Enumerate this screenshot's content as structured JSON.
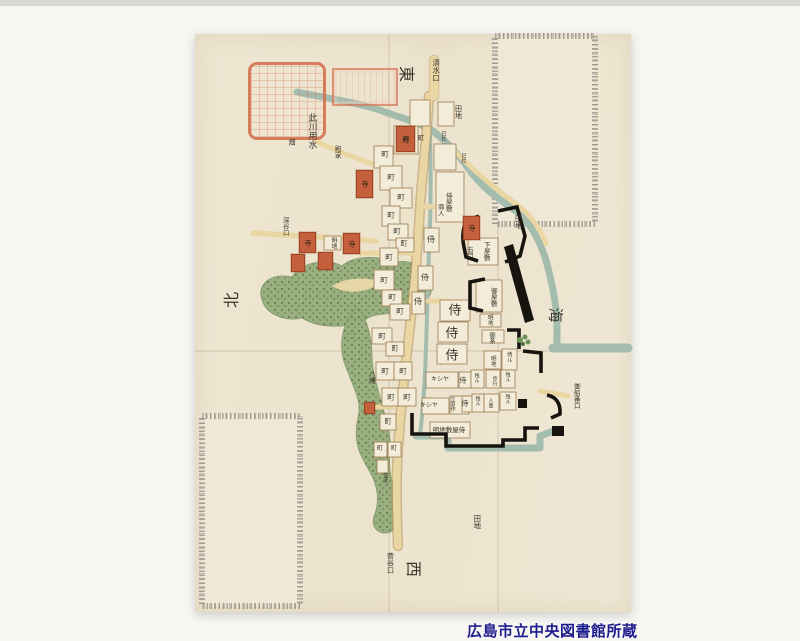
{
  "caption": {
    "text": "広島市立中央図書館所蔵"
  },
  "map": {
    "colors": {
      "background": "#f7f6f3",
      "background_top_strip": "#d8d6d3",
      "paper": "#ede4cf",
      "road": "#e9d6a2",
      "road_edge": "#b5905c",
      "block": "#f3ecd8",
      "block_edge": "#9b7b50",
      "water": "#a4bcae",
      "hill_green": "#96ad7c",
      "hill_dot": "#59753f",
      "temple_red": "#c4613c",
      "castle_wall": "#17140f",
      "seal_red": "#d4714e",
      "ink": "#3a342c",
      "caption_navy": "#1c1c8f",
      "speckle_gray": "#a29d94"
    },
    "labels": [
      {
        "t": "東",
        "x": 406,
        "y": 74,
        "s": 16,
        "r": 90
      },
      {
        "t": "北",
        "x": 232,
        "y": 300,
        "s": 16,
        "r": -90
      },
      {
        "t": "海",
        "x": 555,
        "y": 315,
        "s": 15,
        "r": 90
      },
      {
        "t": "西",
        "x": 413,
        "y": 569,
        "s": 16,
        "r": 90
      },
      {
        "t": "清水口",
        "x": 436,
        "y": 70,
        "s": 7.5,
        "m": "v"
      },
      {
        "t": "田地",
        "x": 458,
        "y": 112,
        "s": 7,
        "m": "v"
      },
      {
        "t": "此川用水",
        "x": 311,
        "y": 131,
        "s": 9,
        "m": "v"
      },
      {
        "t": "畑",
        "x": 292,
        "y": 143,
        "s": 7
      },
      {
        "t": "殿家",
        "x": 337,
        "y": 152,
        "s": 6.5,
        "m": "v"
      },
      {
        "t": "深谷口",
        "x": 285,
        "y": 226,
        "s": 6.5,
        "m": "v"
      },
      {
        "t": "明地",
        "x": 333,
        "y": 243,
        "s": 6,
        "m": "v"
      },
      {
        "t": "田地",
        "x": 518,
        "y": 222,
        "s": 7,
        "m": "v"
      },
      {
        "t": "八幡",
        "x": 371,
        "y": 377,
        "s": 6.5,
        "m": "v"
      },
      {
        "t": "御船番口",
        "x": 576,
        "y": 396,
        "s": 6.5,
        "m": "v"
      },
      {
        "t": "田地",
        "x": 477,
        "y": 522,
        "s": 7.5,
        "m": "v"
      },
      {
        "t": "菅谷口",
        "x": 390,
        "y": 563,
        "s": 7,
        "m": "v"
      },
      {
        "t": "並木",
        "x": 384,
        "y": 478,
        "s": 5.5,
        "m": "v"
      },
      {
        "t": "巳社",
        "x": 443,
        "y": 136,
        "s": 5,
        "m": "v"
      },
      {
        "t": "巳社",
        "x": 463,
        "y": 158,
        "s": 5,
        "m": "v"
      },
      {
        "t": "侍屋敷",
        "x": 448,
        "y": 202,
        "s": 6.5,
        "m": "v"
      },
      {
        "t": "商人",
        "x": 440,
        "y": 210,
        "s": 6.5,
        "m": "v"
      },
      {
        "t": "下屋敷",
        "x": 486,
        "y": 251,
        "s": 6.5,
        "m": "v"
      },
      {
        "t": "右門",
        "x": 469,
        "y": 252,
        "s": 6,
        "m": "v"
      },
      {
        "t": "御屋敷",
        "x": 493,
        "y": 297,
        "s": 6.5,
        "m": "v"
      },
      {
        "t": "明地",
        "x": 489,
        "y": 320,
        "s": 5.5,
        "m": "v"
      },
      {
        "t": "御茶",
        "x": 491,
        "y": 338,
        "s": 6,
        "m": "v"
      },
      {
        "t": "明地",
        "x": 492,
        "y": 361,
        "s": 5.5,
        "m": "v"
      },
      {
        "t": "侍ル",
        "x": 508,
        "y": 357,
        "s": 5.5,
        "m": "v"
      },
      {
        "t": "残ル",
        "x": 476,
        "y": 378,
        "s": 5,
        "m": "v"
      },
      {
        "t": "歩行",
        "x": 494,
        "y": 381,
        "s": 5,
        "m": "v"
      },
      {
        "t": "残ル",
        "x": 507,
        "y": 377,
        "s": 5,
        "m": "v"
      },
      {
        "t": "キシヤ",
        "x": 440,
        "y": 380,
        "s": 6
      },
      {
        "t": "侍",
        "x": 463,
        "y": 381,
        "s": 7
      },
      {
        "t": "キシヤ",
        "x": 429,
        "y": 406,
        "s": 6
      },
      {
        "t": "立退作",
        "x": 452,
        "y": 404,
        "s": 5,
        "m": "v"
      },
      {
        "t": "侍",
        "x": 465,
        "y": 404,
        "s": 7
      },
      {
        "t": "残ル",
        "x": 477,
        "y": 401,
        "s": 5,
        "m": "v"
      },
      {
        "t": "人置",
        "x": 490,
        "y": 403,
        "s": 5,
        "m": "v"
      },
      {
        "t": "残ル",
        "x": 507,
        "y": 399,
        "s": 5,
        "m": "v"
      },
      {
        "t": "明地敷屋侍",
        "x": 449,
        "y": 430,
        "s": 6.5
      },
      {
        "t": "侍",
        "x": 431,
        "y": 240,
        "s": 8
      },
      {
        "t": "侍",
        "x": 425,
        "y": 278,
        "s": 8
      },
      {
        "t": "侍",
        "x": 418,
        "y": 302,
        "s": 8
      },
      {
        "t": "侍",
        "x": 455,
        "y": 311,
        "s": 13
      },
      {
        "t": "侍",
        "x": 452,
        "y": 334,
        "s": 13
      },
      {
        "t": "侍",
        "x": 452,
        "y": 356,
        "s": 13
      },
      {
        "t": "町",
        "x": 406,
        "y": 140,
        "s": 7.5
      },
      {
        "t": "町",
        "x": 421,
        "y": 138,
        "s": 6.5
      },
      {
        "t": "町",
        "x": 385,
        "y": 154,
        "s": 7.5
      },
      {
        "t": "町",
        "x": 391,
        "y": 177,
        "s": 7.5
      },
      {
        "t": "町",
        "x": 401,
        "y": 197,
        "s": 7.5
      },
      {
        "t": "町",
        "x": 391,
        "y": 215,
        "s": 7.5
      },
      {
        "t": "町",
        "x": 397,
        "y": 231,
        "s": 7.5
      },
      {
        "t": "町",
        "x": 404,
        "y": 244,
        "s": 7
      },
      {
        "t": "町",
        "x": 389,
        "y": 257,
        "s": 7.5
      },
      {
        "t": "町",
        "x": 384,
        "y": 280,
        "s": 7.5
      },
      {
        "t": "町",
        "x": 392,
        "y": 297,
        "s": 7.5
      },
      {
        "t": "町",
        "x": 400,
        "y": 311,
        "s": 7.5
      },
      {
        "t": "町",
        "x": 382,
        "y": 336,
        "s": 7.5
      },
      {
        "t": "町",
        "x": 395,
        "y": 349,
        "s": 7
      },
      {
        "t": "町",
        "x": 385,
        "y": 371,
        "s": 7.5
      },
      {
        "t": "町",
        "x": 403,
        "y": 371,
        "s": 7.5
      },
      {
        "t": "町",
        "x": 391,
        "y": 397,
        "s": 7.5
      },
      {
        "t": "町",
        "x": 407,
        "y": 397,
        "s": 7.5
      },
      {
        "t": "町",
        "x": 388,
        "y": 422,
        "s": 7
      },
      {
        "t": "町",
        "x": 380,
        "y": 449,
        "s": 6
      },
      {
        "t": "町",
        "x": 394,
        "y": 449,
        "s": 6
      }
    ],
    "red_buildings": [
      {
        "x": 396,
        "y": 126,
        "w": 17,
        "h": 24,
        "label": "寺"
      },
      {
        "x": 356,
        "y": 170,
        "w": 15,
        "h": 26,
        "label": "寺"
      },
      {
        "x": 299,
        "y": 232,
        "w": 15,
        "h": 19,
        "label": "寺"
      },
      {
        "x": 343,
        "y": 233,
        "w": 15,
        "h": 19,
        "label": "寺"
      },
      {
        "x": 318,
        "y": 252,
        "w": 13,
        "h": 16,
        "label": ""
      },
      {
        "x": 291,
        "y": 254,
        "w": 12,
        "h": 16,
        "label": ""
      },
      {
        "x": 463,
        "y": 216,
        "w": 15,
        "h": 22,
        "label": "寺"
      },
      {
        "x": 364,
        "y": 402,
        "w": 9,
        "h": 10,
        "label": ""
      }
    ]
  }
}
